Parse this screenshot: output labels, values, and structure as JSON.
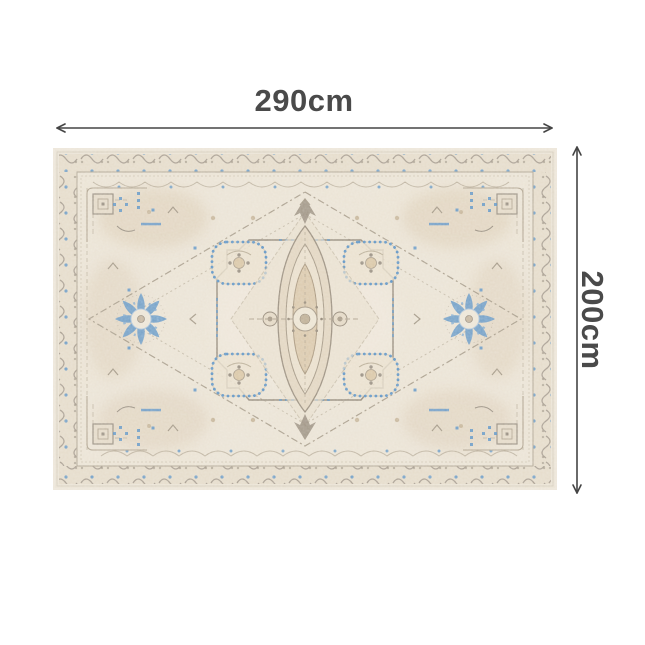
{
  "page": {
    "background_color": "#ffffff"
  },
  "dimension_annotation": {
    "width_label": "290cm",
    "height_label": "200cm",
    "text_color": "#4a4a4a",
    "arrow_color": "#454545"
  },
  "icons": {
    "width_arrow": "double-headed-horizontal-arrow",
    "height_arrow": "double-headed-vertical-arrow"
  },
  "product": {
    "description": "Vintage-style distressed oriental medallion area rug in cream and beige with blue accents",
    "palette": {
      "rug_base": "#EAE3D6",
      "rug_beige": "#D8C5AC",
      "border_band": "#E1D7C6",
      "taupe_line": "#8F8578",
      "dark_taupe": "#7D7365",
      "accent_blue": "#4E8BC4"
    }
  }
}
